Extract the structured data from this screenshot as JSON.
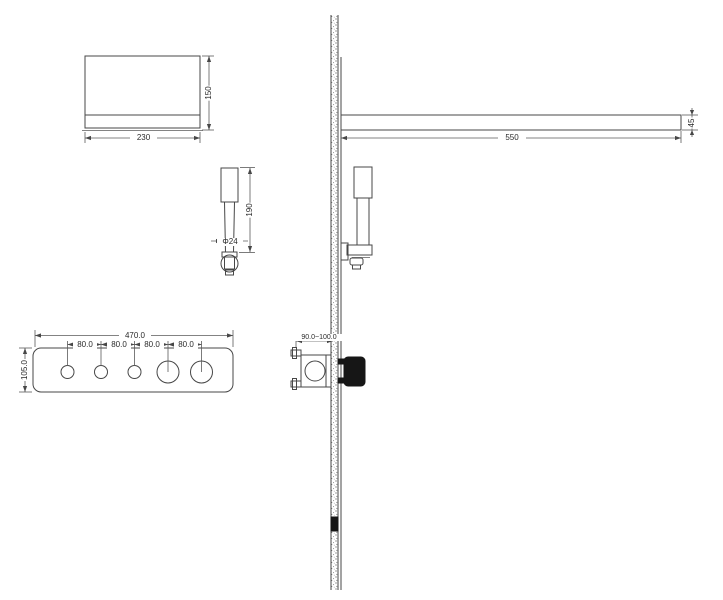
{
  "drawing_title": "shower-system-installation-technical-drawing",
  "colors": {
    "line": "#474747",
    "paper": "#ffffff",
    "knob_fill": "#161616"
  },
  "views": {
    "shower_head_front": {
      "width_label": "230",
      "height_label": "150"
    },
    "hand_shower_front": {
      "length_label": "190",
      "diameter_label": "Φ24"
    },
    "control_panel": {
      "width_label": "470.0",
      "height_label": "105.0",
      "spacing_labels": [
        "80.0",
        "80.0",
        "80.0",
        "80.0"
      ],
      "small_knob_count": 3,
      "large_knob_count": 2
    },
    "installation_side": {
      "arm_length_label": "550",
      "arm_end_label": "45",
      "valve_depth_label": "90.0~100.0"
    }
  }
}
